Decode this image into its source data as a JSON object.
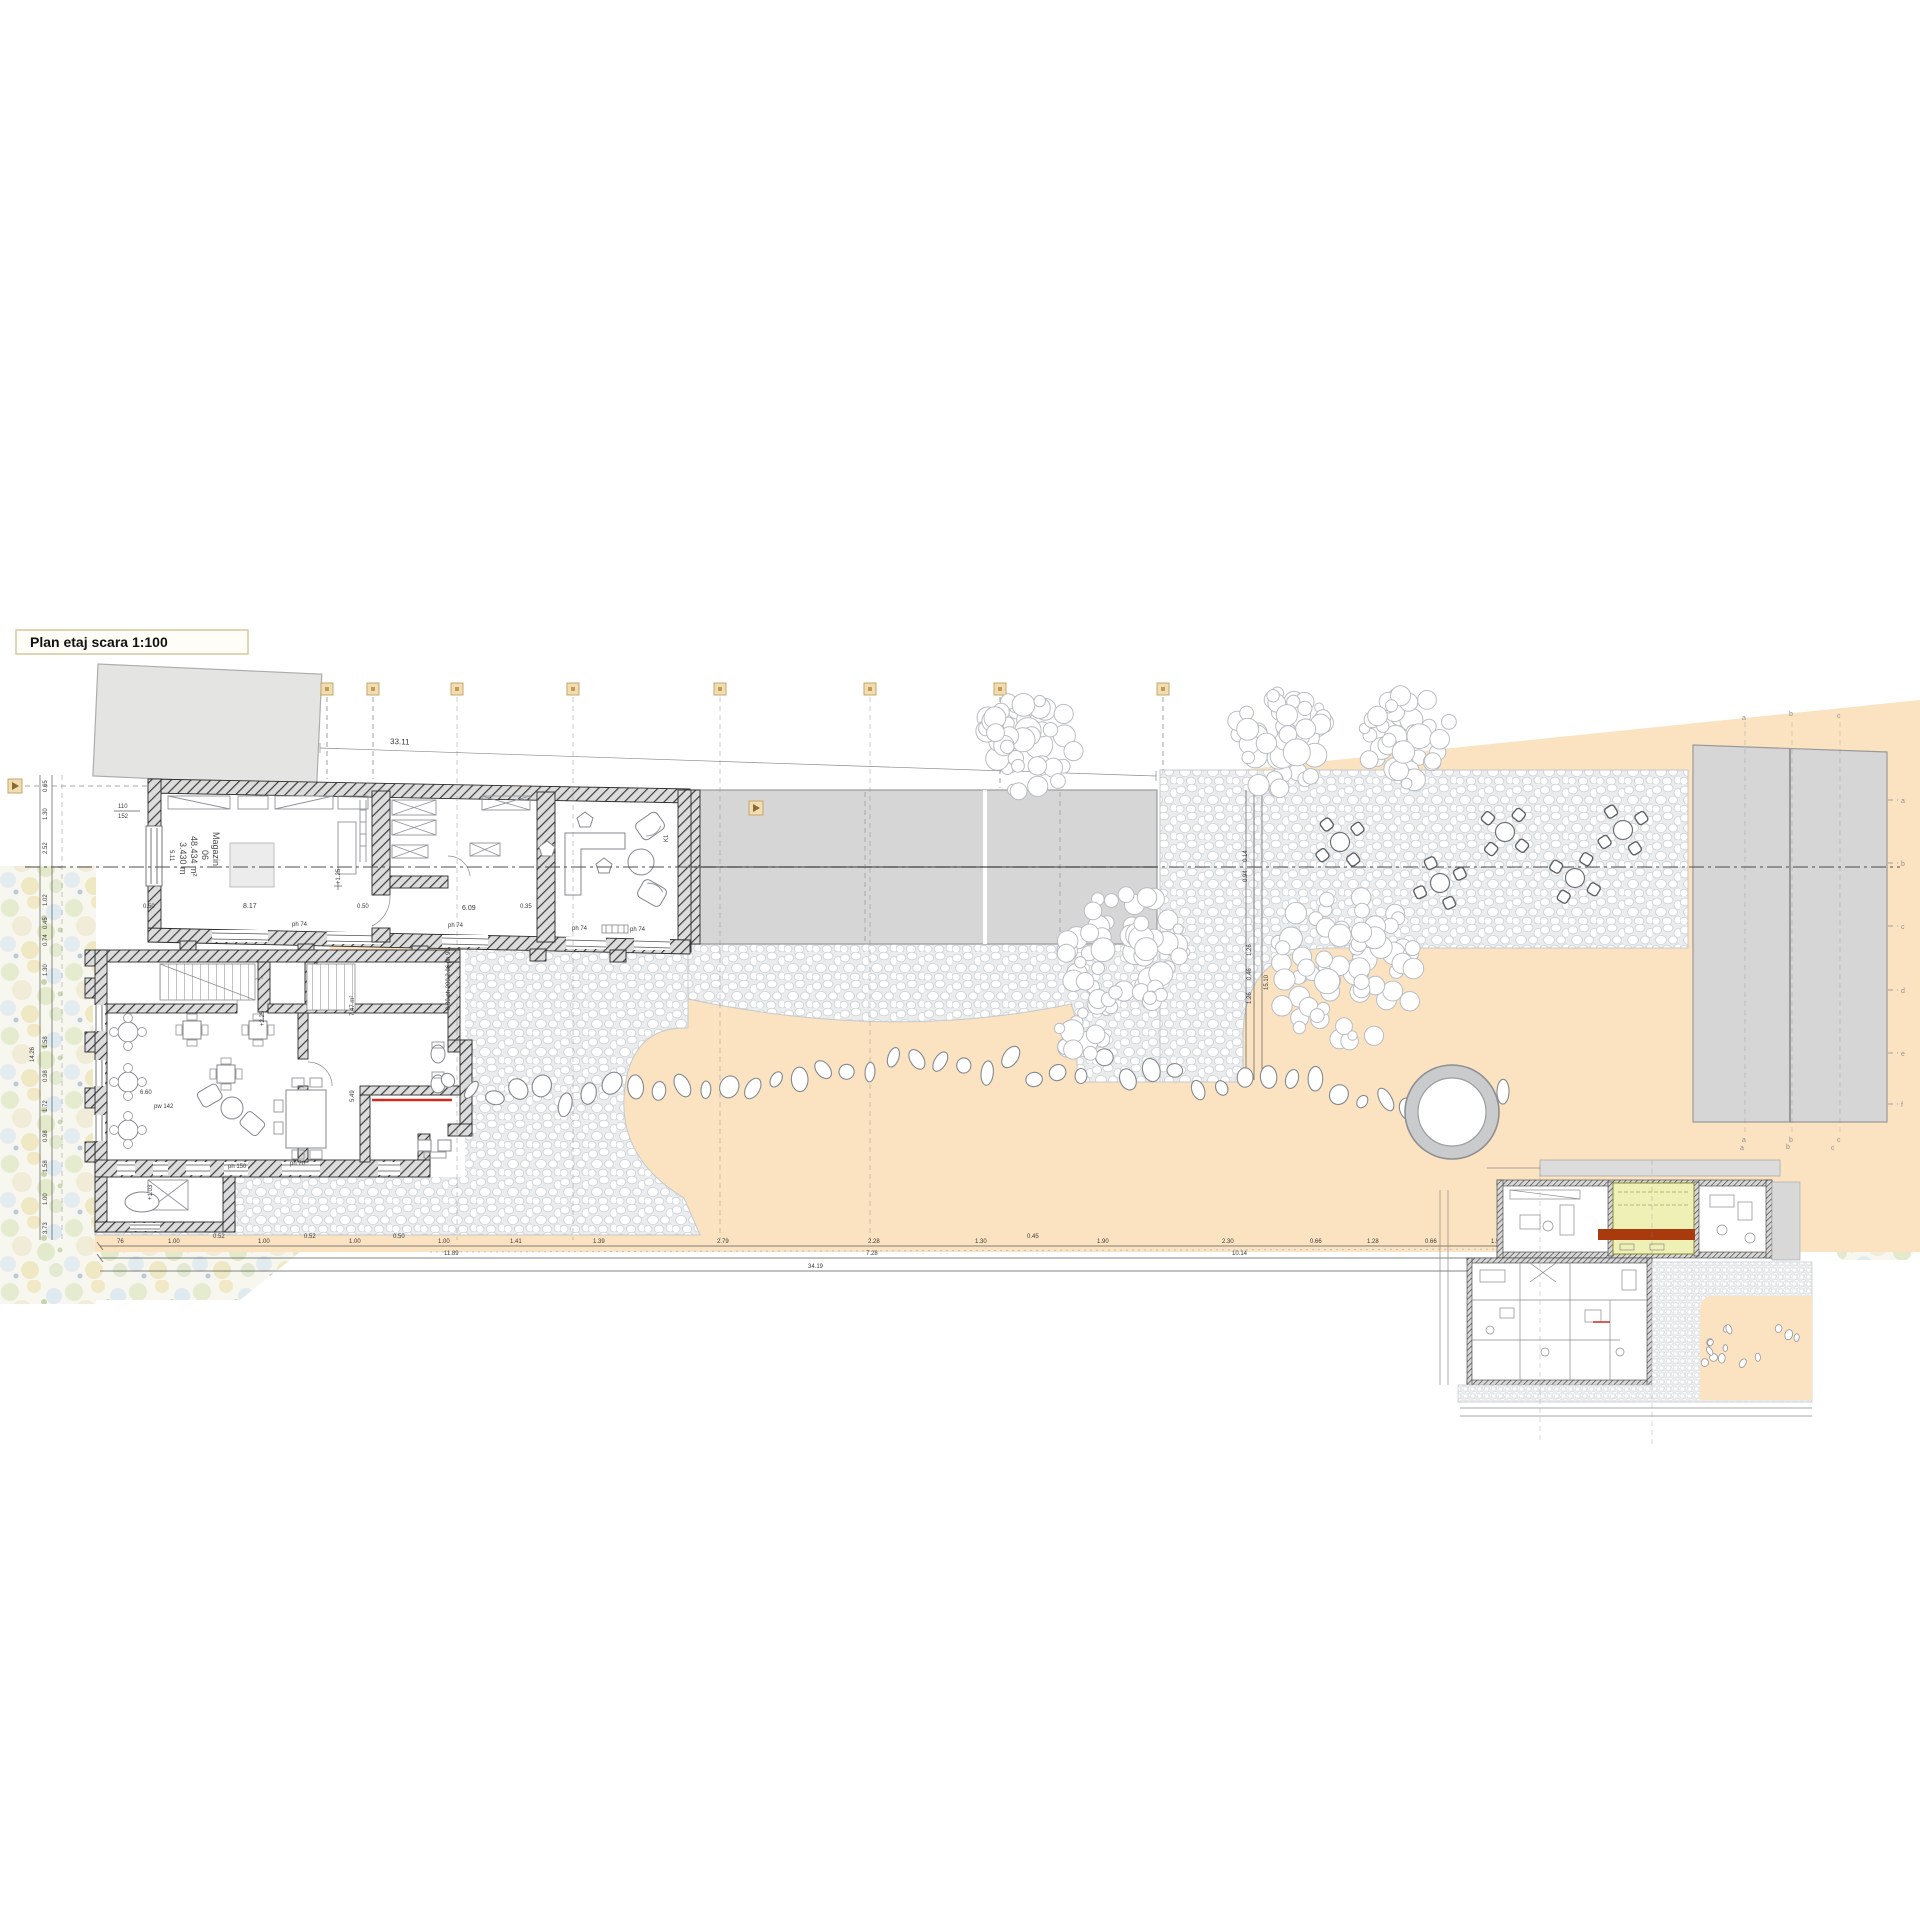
{
  "title": {
    "label": "Plan etaj scara 1:100"
  },
  "rooms": {
    "magazin": {
      "name": "Magazin",
      "number": "06",
      "area": "48.434 m²",
      "height": "3.430 m",
      "side": "5.11"
    },
    "office": {
      "label": "K1"
    }
  },
  "dims": {
    "top_total": "33.11",
    "door_top": "110",
    "door_bottom": "152",
    "magazin_width": "8.17",
    "magazin_left": "0.50",
    "magazin_right": "0.50",
    "roomb_width": "6.09",
    "roomb_gap": "0.35",
    "window_label": "ph 74",
    "junction_stack": "0.30  ph 200  2.06  ph 90",
    "area_747": "7.47 m²",
    "level_upper": "+1.25",
    "level_225": "+2.25",
    "level_103": "+1.03",
    "pw142": "pw 142",
    "ph70": "ph 70",
    "ph150": "ph 150",
    "d660": "6.60",
    "d549": "5.49",
    "path_chain": [
      "1.26",
      "0.46",
      "1.26"
    ],
    "path_total": "15.10",
    "path_s1": "0.14",
    "path_s2": "0.94",
    "left_chain": [
      "0.65",
      "1.30",
      "2.52",
      "1.02",
      "0.45",
      "0.74",
      "1.30",
      "1.58",
      "0.98",
      "1.72",
      "0.98",
      "1.58",
      "1.00",
      "3.73"
    ],
    "left_total": "14.26",
    "bottom_chain": [
      "76",
      "1.00",
      "0.52",
      "1.00",
      "0.52",
      "1.00",
      "0.50",
      "1.00",
      "1.41",
      "1.39",
      "2.79",
      "2.28",
      "1.30",
      "0.45",
      "1.90",
      "2.30",
      "0.66",
      "1.28",
      "0.66",
      "1.55"
    ],
    "bottom_sub1": "11.89",
    "bottom_sub2": "7.28",
    "bottom_sub3": "10.14",
    "bottom_total": "34.19"
  },
  "axes": {
    "right_top": [
      "a",
      "b",
      "c"
    ],
    "right_bottom": [
      "a",
      "b",
      "c"
    ],
    "right_edge": [
      "a",
      "b",
      "c",
      "d",
      "e",
      "f"
    ]
  },
  "inset": {
    "axis_letters": [
      "a",
      "b",
      "c"
    ]
  },
  "colors": {
    "beige": "#fbe3c2",
    "roof_gray": "#d5d6d5",
    "highlight_yellow": "#eff0b5",
    "highlight_red": "#a83a0e",
    "marker_tan": "#f0ddb2"
  }
}
